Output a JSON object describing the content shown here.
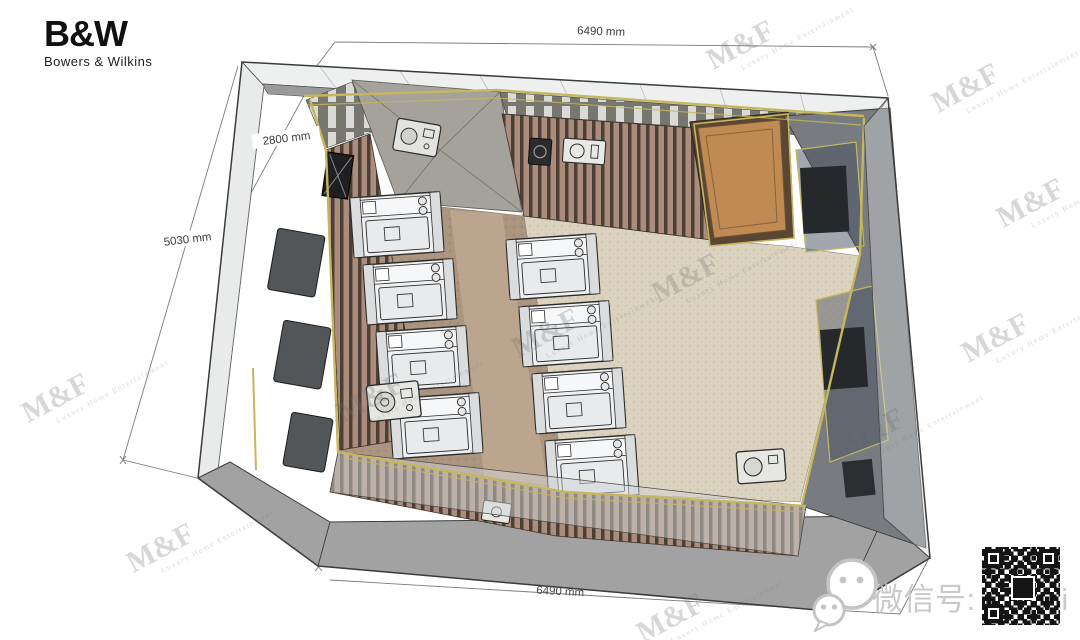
{
  "brand": {
    "logo": "B&W",
    "name": "Bowers & Wilkins"
  },
  "dimensions": {
    "width_top": "6490 mm",
    "height": "2800 mm",
    "depth": "5030 mm",
    "width_bottom": "6490 mm"
  },
  "watermark": {
    "main": "M&F",
    "sub": "Luxury Home Entertainment"
  },
  "wechat": {
    "label": "微信号: hdhivi"
  },
  "colors": {
    "trim_gold": "#c6b75e",
    "floor_carpet": "#dcd2c0",
    "floor_brown": "#ab9480",
    "aisle": "#bca58e",
    "wood_slat": "#5f4c3d",
    "door_wood": "#c08a55",
    "ceiling_gray": "#a5a19b",
    "glass": "#eef0f0",
    "plinth": "#a2a2a2",
    "screen_wall": "#787c80",
    "seat": "#eef0f2"
  }
}
